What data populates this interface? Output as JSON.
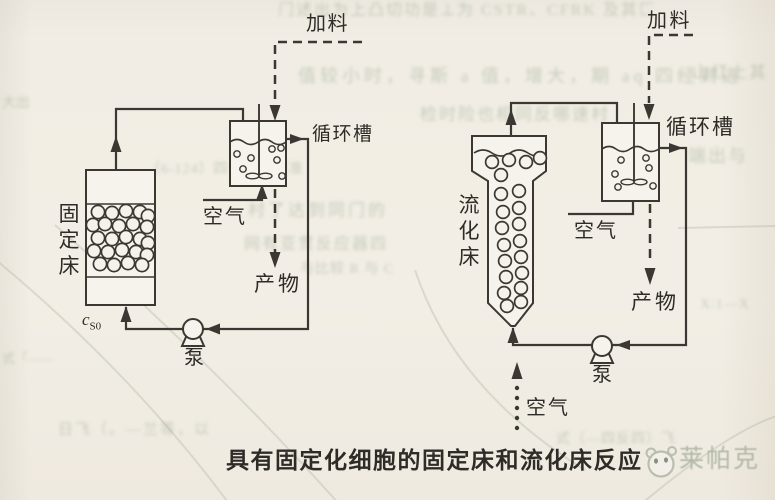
{
  "page": {
    "ink": "#3b3833",
    "paper": "#f2eee5",
    "bleed_color": "#9dab93"
  },
  "caption": {
    "text": "具有固定化细胞的固定床和流化床反应"
  },
  "watermark": {
    "text": "莱帕克",
    "color": "#b2b9a8"
  },
  "left_diagram": {
    "feed_label": "加料",
    "tank_label": "循环槽",
    "air_label": "空气",
    "product_label": "产物",
    "pump_label": "泵",
    "bed_label": "固定床",
    "inlet_symbol": {
      "base": "c",
      "sub": "S0"
    },
    "bed_cells": [
      [
        98,
        212
      ],
      [
        112,
        213
      ],
      [
        126,
        211
      ],
      [
        140,
        212
      ],
      [
        148,
        216
      ],
      [
        93,
        225
      ],
      [
        105,
        224
      ],
      [
        119,
        226
      ],
      [
        133,
        224
      ],
      [
        147,
        227
      ],
      [
        98,
        238
      ],
      [
        112,
        239
      ],
      [
        126,
        237
      ],
      [
        140,
        239
      ],
      [
        148,
        243
      ],
      [
        94,
        251
      ],
      [
        108,
        252
      ],
      [
        122,
        250
      ],
      [
        136,
        252
      ],
      [
        147,
        255
      ],
      [
        100,
        264
      ],
      [
        114,
        265
      ],
      [
        128,
        263
      ],
      [
        142,
        265
      ]
    ],
    "tank_bubbles": [
      [
        237,
        154
      ],
      [
        251,
        158
      ],
      [
        243,
        169
      ],
      [
        272,
        149
      ],
      [
        281,
        148
      ],
      [
        277,
        160
      ],
      [
        282,
        176
      ]
    ]
  },
  "right_diagram": {
    "feed_label": "加料",
    "tank_label": "循环槽",
    "air_tank_label": "空气",
    "air_bottom_label": "空气",
    "product_label": "产物",
    "pump_label": "泵",
    "bed_label": "流化床",
    "bed_cells": [
      [
        492,
        162
      ],
      [
        509,
        160
      ],
      [
        526,
        162
      ],
      [
        540,
        158
      ],
      [
        501,
        175
      ],
      [
        519,
        191
      ],
      [
        501,
        194
      ],
      [
        503,
        212
      ],
      [
        519,
        208
      ],
      [
        502,
        228
      ],
      [
        519,
        224
      ],
      [
        504,
        245
      ],
      [
        520,
        241
      ],
      [
        505,
        261
      ],
      [
        521,
        257
      ],
      [
        506,
        277
      ],
      [
        522,
        273
      ],
      [
        504,
        293
      ],
      [
        521,
        288
      ],
      [
        507,
        306
      ],
      [
        521,
        302
      ]
    ],
    "tank_bubbles": [
      [
        621,
        160
      ],
      [
        615,
        174
      ],
      [
        618,
        187
      ],
      [
        646,
        158
      ],
      [
        649,
        168
      ],
      [
        653,
        186
      ]
    ],
    "air_dots": [
      [
        517,
        388
      ],
      [
        517,
        398
      ],
      [
        517,
        408
      ],
      [
        517,
        418
      ],
      [
        517,
        428
      ]
    ]
  },
  "bleedthrough": {
    "snippets": [
      {
        "text": "门述出为上凸切功是⊥为 CSTR、CFRK 及其匚",
        "x": 278,
        "y": -4,
        "size": 16,
        "ls": 2
      },
      {
        "text": "值较小时，寻斯 a 值，增大，期 aq 四经到进",
        "x": 298,
        "y": 62,
        "size": 18,
        "ls": 4
      },
      {
        "text": "检时险也相同反哪速村",
        "x": 420,
        "y": 100,
        "size": 17,
        "ls": 2
      },
      {
        "text": "山红上其",
        "x": 692,
        "y": 58,
        "size": 17,
        "ls": 2
      },
      {
        "text": "端出与",
        "x": 688,
        "y": 142,
        "size": 18,
        "ls": 2
      },
      {
        "text": "（6-124）四一反应标准",
        "x": 146,
        "y": 158,
        "size": 14,
        "ls": 1
      },
      {
        "text": "村了达到同门的",
        "x": 248,
        "y": 196,
        "size": 17,
        "ls": 3
      },
      {
        "text": "网有亚贯反应器四",
        "x": 244,
        "y": 230,
        "size": 16,
        "ls": 2
      },
      {
        "text": "与比较 R 与 C",
        "x": 300,
        "y": 258,
        "size": 14,
        "ls": 1
      },
      {
        "text": "X∶1—X",
        "x": 700,
        "y": 296,
        "size": 14,
        "ls": 1
      },
      {
        "text": "式（—四反四）飞",
        "x": 556,
        "y": 428,
        "size": 14,
        "ls": 1
      },
      {
        "text": "日飞（。—兰等，以",
        "x": 58,
        "y": 418,
        "size": 15,
        "ls": 2
      },
      {
        "text": "式「——",
        "x": 2,
        "y": 348,
        "size": 13,
        "ls": 0
      },
      {
        "text": "大出",
        "x": 2,
        "y": 92,
        "size": 14,
        "ls": 0
      }
    ]
  }
}
